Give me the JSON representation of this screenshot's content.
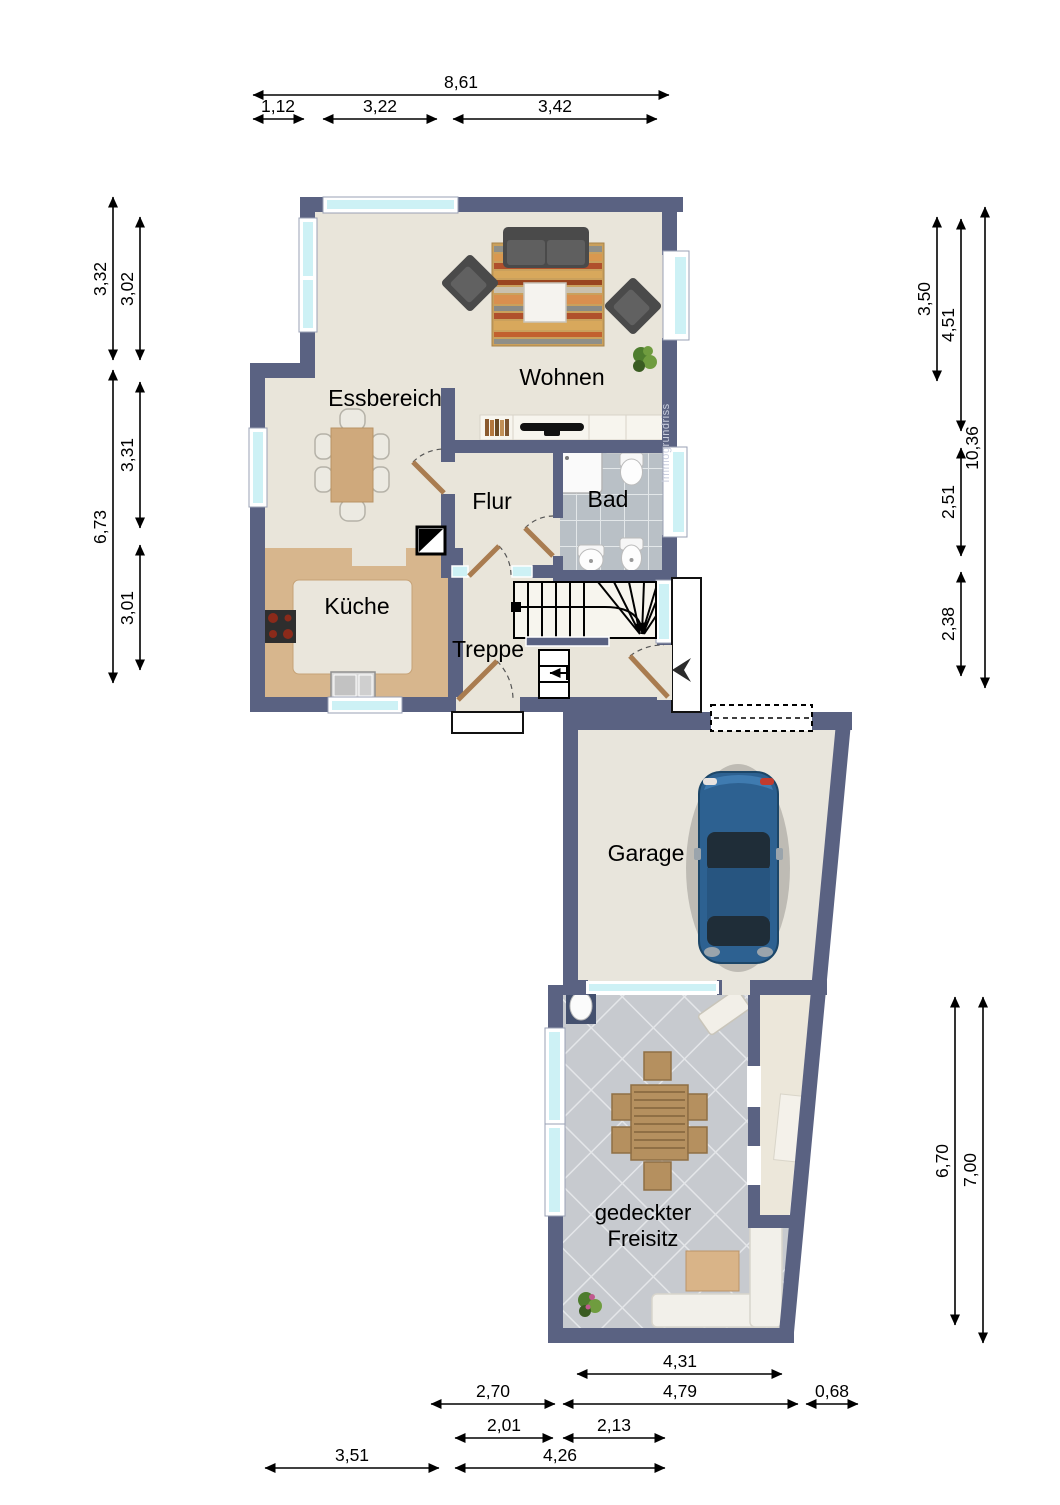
{
  "title": "Erdgeschoss Grundriss",
  "watermark": "Immogrundriss",
  "rooms": {
    "wohnen": "Wohnen",
    "essbereich": "Essbereich",
    "flur": "Flur",
    "bad": "Bad",
    "kueche": "Küche",
    "treppe": "Treppe",
    "garage": "Garage",
    "freisitz_line1": "gedeckter",
    "freisitz_line2": "Freisitz"
  },
  "dimensions": {
    "top": [
      {
        "value": "8,61"
      },
      {
        "value": "1,12"
      },
      {
        "value": "3,22"
      },
      {
        "value": "3,42"
      }
    ],
    "left": [
      {
        "value": "3,32"
      },
      {
        "value": "3,02"
      },
      {
        "value": "6,73"
      },
      {
        "value": "3,31"
      },
      {
        "value": "3,01"
      }
    ],
    "right": [
      {
        "value": "3,50"
      },
      {
        "value": "4,51"
      },
      {
        "value": "10,36"
      },
      {
        "value": "2,51"
      },
      {
        "value": "2,38"
      },
      {
        "value": "6,70"
      },
      {
        "value": "7,00"
      }
    ],
    "bottom": [
      {
        "value": "4,31"
      },
      {
        "value": "2,70"
      },
      {
        "value": "4,79"
      },
      {
        "value": "0,68"
      },
      {
        "value": "2,01"
      },
      {
        "value": "2,13"
      },
      {
        "value": "3,51"
      },
      {
        "value": "4,26"
      }
    ]
  },
  "colors": {
    "wall": "#5a6282",
    "floor": "#e9e5da",
    "kitchen_counter": "#d7b68d",
    "bath_tile": "#b9c0c6",
    "patio_tile": "#c7cacf",
    "window_glass": "#cdf1f5",
    "door_wood": "#a97c50",
    "car_body": "#2d6191",
    "dimension_text": "#000000"
  }
}
